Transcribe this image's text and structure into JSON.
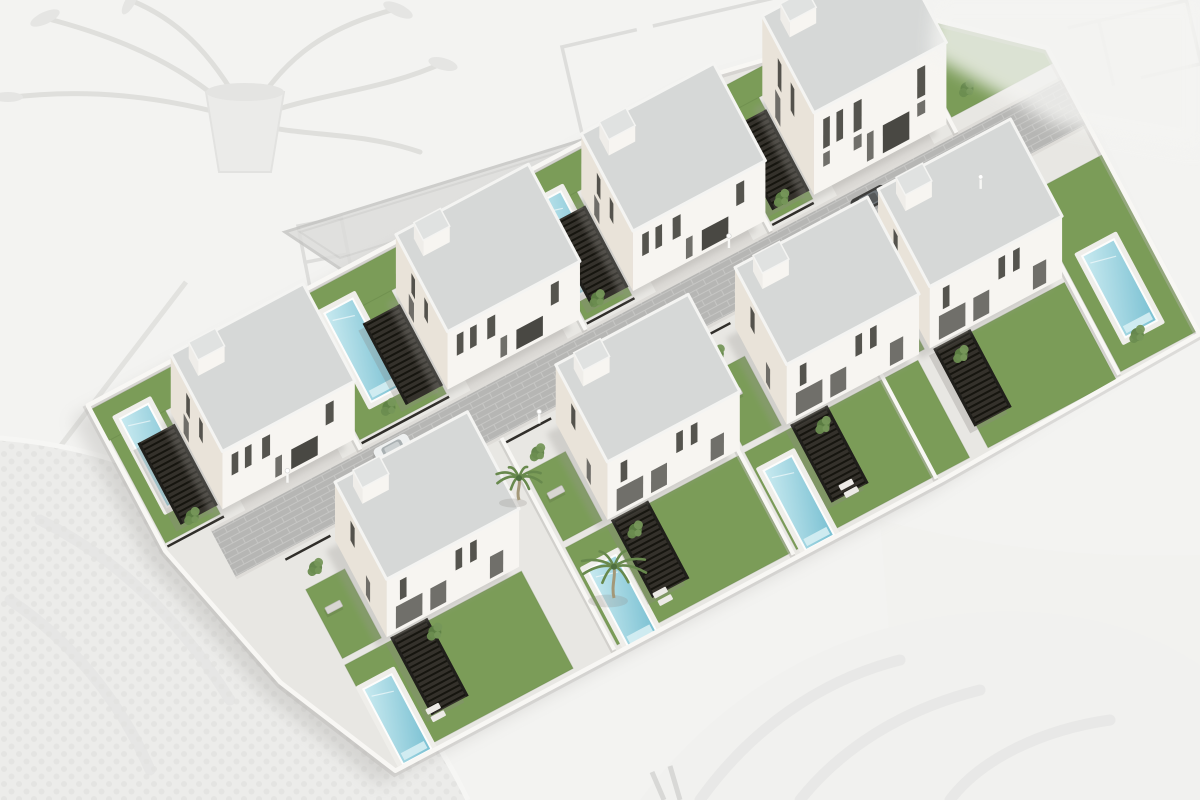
{
  "scene": {
    "type": "3d-architectural-rendering",
    "subject": "Aerial view of a residential development with eight modern white two-storey villas, each with a private pool, lawn and dark pergola, arranged in two rows along a central paved street",
    "background": "washed-out desk scene with faded architectural floor plans, a potted plant and knitted fabric",
    "villa_count": 8,
    "visible_pool_count": 7,
    "palm_count": 2,
    "car_count": 3
  },
  "colors": {
    "bg": "#f3f3f1",
    "base": "#e8e7e3",
    "street": "#b6b6b4",
    "joint": "#c6c6c4",
    "curb": "#dedcd8",
    "apron": "#dcdad6",
    "wallLight": "#f7f5f1",
    "wallShade": "#e9e3d9",
    "roof": "#d6d8d7",
    "roofRim": "#f4f4f2",
    "stairSide": "#efede9",
    "stairTop": "#e0e2e1",
    "window": "#474540",
    "glass": "#64635e",
    "garage": "#3a3834",
    "lawn": "#7b9c58",
    "lawnEdge": "#5e7f42",
    "deck": "#efeeea",
    "step": "#d6eef3",
    "pergola": "#34312b",
    "slat": "#16150f",
    "post": "#201f1b",
    "wallWhite": "#f8f7f4",
    "wallShadow": "#bcbab6",
    "trim": "#302e2a",
    "shadow": "#9b9995",
    "carWhite": "#eef0f0",
    "carDark": "#3e3e3c",
    "carGray": "#8f8f8d",
    "palmTrunk": "#a39878",
    "frond": "#68894d",
    "shrub1": "#5f8246",
    "shrub2": "#76975a",
    "shrub3": "#6b8d50",
    "planLine": "#c8c8c6",
    "decorGray": "#d8d8d6",
    "slab": "#dcdcda",
    "slabEdge": "#c4c4c2",
    "blanket": "#ececea",
    "blanketDot": "#e2e2e0",
    "drape": "#f1f1ef",
    "fold": "#e3e3e1",
    "bench": "#d8d6d2"
  },
  "site": {
    "origin_x": 250,
    "origin_y": 540,
    "rotation_deg": -28,
    "outline": [
      [
        -80,
        -195
      ],
      [
        620,
        -195
      ],
      [
        835,
        -150
      ],
      [
        935,
        -60
      ],
      [
        935,
        264
      ],
      [
        640,
        272
      ],
      [
        20,
        272
      ],
      [
        -40,
        140
      ],
      [
        -80,
        -30
      ]
    ],
    "street_rect": [
      -30,
      -27,
      975,
      54
    ],
    "dividers": [
      {
        "x": 140,
        "y0": -190,
        "y1": -28
      },
      {
        "x": 395,
        "y0": -190,
        "y1": -28
      },
      {
        "x": 605,
        "y0": -190,
        "y1": -28
      },
      {
        "x": 815,
        "y0": -150,
        "y1": -28
      },
      {
        "x": 270,
        "y0": 28,
        "y1": 268
      },
      {
        "x": 473,
        "y0": 28,
        "y1": 268
      },
      {
        "x": 635,
        "y0": 28,
        "y1": 268
      },
      {
        "x": 845,
        "y0": 28,
        "y1": 262
      }
    ],
    "trims": [
      [
        -76,
        -33,
        -12
      ],
      [
        144,
        -33,
        243
      ],
      [
        399,
        -33,
        453
      ],
      [
        609,
        -33,
        656
      ],
      [
        22,
        34,
        73
      ],
      [
        272,
        34,
        323
      ],
      [
        475,
        34,
        526
      ],
      [
        637,
        34,
        688
      ]
    ],
    "lamps": [
      [
        60,
        -33
      ],
      [
        310,
        33
      ],
      [
        560,
        -33
      ],
      [
        810,
        33
      ]
    ],
    "benches": [
      [
        34,
        95
      ],
      [
        284,
        98
      ],
      [
        487,
        95
      ],
      [
        648,
        98
      ]
    ],
    "loungers": [
      [
        75,
        232
      ],
      [
        330,
        236
      ],
      [
        545,
        228
      ]
    ],
    "shrubs": [
      [
        -40,
        -48
      ],
      [
        185,
        -52
      ],
      [
        420,
        -50
      ],
      [
        630,
        -52
      ],
      [
        845,
        -62
      ],
      [
        905,
        -100
      ],
      [
        300,
        -178
      ],
      [
        520,
        -180
      ],
      [
        45,
        55
      ],
      [
        295,
        58
      ],
      [
        500,
        55
      ],
      [
        660,
        58
      ],
      [
        120,
        168
      ],
      [
        345,
        172
      ],
      [
        560,
        168
      ],
      [
        715,
        170
      ],
      [
        880,
        235
      ]
    ],
    "cars": [
      {
        "rect": [
          150,
          -22,
          38,
          17
        ],
        "body": "carWhite",
        "glass": "#a9b0b2"
      },
      {
        "rect": [
          688,
          -18,
          38,
          17
        ],
        "body": "carDark",
        "glass": "#70767a"
      },
      {
        "rect": [
          737,
          3,
          35,
          16
        ],
        "body": "carGray",
        "glass": "#b7bcbe"
      }
    ]
  },
  "villas": [
    {
      "id": "villa-1",
      "row": "upper",
      "house": [
        660,
        -150,
        150,
        110
      ],
      "height": 82,
      "tall": true,
      "stair": [
        14,
        12,
        30,
        20,
        16
      ],
      "pool": null,
      "pergola": [
        616,
        -138,
        42,
        92
      ],
      "lawns": [
        [
          609,
          -155,
          48,
          118
        ],
        [
          605,
          -178,
          205,
          26
        ],
        [
          818,
          -150,
          114,
          106
        ]
      ],
      "apron": [
        680,
        -40,
        110,
        12
      ]
    },
    {
      "id": "villa-2",
      "row": "upper",
      "house": [
        455,
        -150,
        150,
        110
      ],
      "height": 60,
      "stair": [
        14,
        12,
        30,
        20,
        16
      ],
      "pool": [
        406,
        -162,
        32,
        100
      ],
      "pergola": [
        411,
        -138,
        42,
        92
      ],
      "lawns": [
        [
          399,
          -155,
          53,
          118
        ],
        [
          395,
          -190,
          208,
          36
        ]
      ],
      "apron": [
        475,
        -40,
        110,
        12
      ]
    },
    {
      "id": "villa-3",
      "row": "upper",
      "house": [
        245,
        -150,
        150,
        110
      ],
      "height": 58,
      "stair": [
        14,
        12,
        30,
        20,
        16
      ],
      "pool": [
        172,
        -165,
        32,
        100
      ],
      "pergola": [
        201,
        -138,
        42,
        92
      ],
      "lawns": [
        [
          144,
          -155,
          98,
          118
        ],
        [
          140,
          -190,
          253,
          36
        ]
      ],
      "apron": [
        265,
        -40,
        110,
        12
      ]
    },
    {
      "id": "villa-4",
      "row": "upper",
      "house": [
        -10,
        -150,
        150,
        110
      ],
      "height": 58,
      "stair": [
        14,
        12,
        30,
        20,
        16
      ],
      "pool": [
        -58,
        -168,
        32,
        100
      ],
      "pergola": [
        -54,
        -138,
        42,
        92
      ],
      "lawns": [
        [
          -76,
          -155,
          62,
          118
        ],
        [
          -80,
          -190,
          218,
          36
        ]
      ],
      "apron": [
        10,
        -40,
        110,
        12
      ]
    },
    {
      "id": "villa-5",
      "row": "lower",
      "house": [
        690,
        40,
        150,
        110
      ],
      "height": 62,
      "stair": [
        14,
        12,
        30,
        20,
        16
      ],
      "pool": [
        868,
        140,
        36,
        92
      ],
      "pergola": [
        693,
        152,
        42,
        88
      ],
      "lawns": [
        [
          695,
          155,
          145,
          110
        ],
        [
          848,
          60,
          86,
          200
        ],
        [
          641,
          70,
          44,
          78
        ]
      ],
      "apron": [
        710,
        28,
        110,
        12
      ]
    },
    {
      "id": "villa-6",
      "row": "lower",
      "house": [
        528,
        40,
        150,
        110
      ],
      "height": 60,
      "stair": [
        14,
        12,
        30,
        20,
        16
      ],
      "pool": [
        486,
        180,
        32,
        90
      ],
      "pergola": [
        531,
        152,
        42,
        88
      ],
      "lawns": [
        [
          478,
          155,
          196,
          110
        ],
        [
          479,
          70,
          44,
          78
        ]
      ],
      "apron": [
        548,
        28,
        110,
        12
      ]
    },
    {
      "id": "villa-7",
      "row": "lower",
      "house": [
        325,
        40,
        150,
        110
      ],
      "height": 58,
      "stair": [
        14,
        12,
        30,
        20,
        16
      ],
      "pool": [
        284,
        185,
        32,
        88
      ],
      "pergola": [
        328,
        152,
        42,
        88
      ],
      "lawns": [
        [
          275,
          155,
          196,
          110
        ],
        [
          276,
          70,
          44,
          78
        ]
      ],
      "apron": [
        345,
        28,
        110,
        12
      ]
    },
    {
      "id": "villa-8",
      "row": "lower",
      "house": [
        75,
        40,
        150,
        110
      ],
      "height": 58,
      "stair": [
        14,
        12,
        30,
        20,
        16
      ],
      "pool": [
        30,
        185,
        32,
        85
      ],
      "pergola": [
        78,
        152,
        42,
        88
      ],
      "lawns": [
        [
          25,
          155,
          200,
          110
        ],
        [
          26,
          70,
          44,
          78
        ]
      ],
      "apron": [
        95,
        28,
        110,
        12
      ]
    }
  ],
  "windows": {
    "upper_front": [
      [
        0.07,
        0.05,
        0.5,
        0.86
      ],
      [
        0.17,
        0.05,
        0.5,
        0.86
      ],
      [
        0.3,
        0.06,
        0.5,
        0.86
      ],
      [
        0.52,
        0.2,
        0.06,
        0.4
      ],
      [
        0.78,
        0.06,
        0.5,
        0.86
      ],
      [
        0.4,
        0.05,
        0.06,
        0.4
      ]
    ],
    "upper_left": [
      [
        0.3,
        0.07,
        0.5,
        0.84
      ],
      [
        0.55,
        0.07,
        0.5,
        0.84
      ],
      [
        0.25,
        0.1,
        0.06,
        0.4
      ]
    ],
    "lower_front": [
      [
        0.07,
        0.2,
        0.06,
        0.44
      ],
      [
        0.33,
        0.12,
        0.06,
        0.44
      ],
      [
        0.52,
        0.05,
        0.52,
        0.86
      ],
      [
        0.63,
        0.05,
        0.52,
        0.86
      ],
      [
        0.78,
        0.1,
        0.06,
        0.44
      ],
      [
        0.1,
        0.05,
        0.52,
        0.86
      ]
    ],
    "lower_left": [
      [
        0.3,
        0.08,
        0.5,
        0.84
      ],
      [
        0.6,
        0.08,
        0.06,
        0.4
      ]
    ],
    "mid_row": [
      [
        0.07,
        0.05,
        0.28,
        0.44
      ],
      [
        0.3,
        0.06,
        0.28,
        0.44
      ],
      [
        0.78,
        0.06,
        0.28,
        0.44
      ]
    ]
  },
  "palms": [
    {
      "x": 614,
      "y": 598,
      "size": 40
    },
    {
      "x": 519,
      "y": 500,
      "size": 28
    }
  ]
}
